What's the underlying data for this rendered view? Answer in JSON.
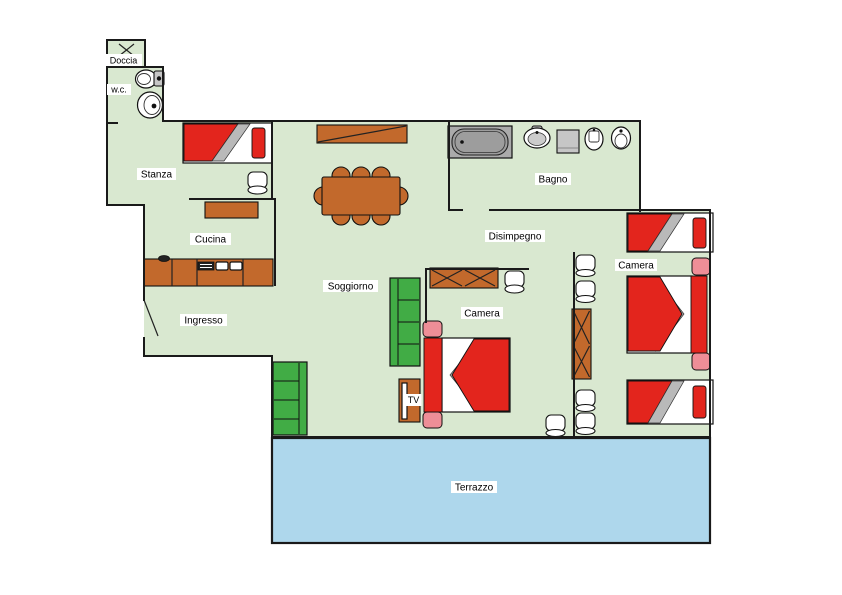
{
  "colors": {
    "floor": "#d9e8d0",
    "terrace": "#aed7ec",
    "wood": "#c2692c",
    "red": "#e3251d",
    "pink": "#ee8e97",
    "sofa": "#41ac45",
    "tub": "#aaaaaa",
    "gray": "#b9b9b9",
    "appliance": "#c6c6c6",
    "wall": "#1a1a1a"
  },
  "rooms": {
    "doccia": {
      "label": "Doccia"
    },
    "wc": {
      "label": "w.c."
    },
    "stanza": {
      "label": "Stanza"
    },
    "cucina": {
      "label": "Cucina"
    },
    "ingresso": {
      "label": "Ingresso"
    },
    "soggiorno": {
      "label": "Soggiorno"
    },
    "bagno": {
      "label": "Bagno"
    },
    "disimpegno": {
      "label": "Disimpegno"
    },
    "camera_centrale": {
      "label": "Camera"
    },
    "camera_destra": {
      "label": "Camera"
    },
    "terrazzo": {
      "label": "Terrazzo"
    }
  },
  "furniture": {
    "tv_label": "TV"
  }
}
